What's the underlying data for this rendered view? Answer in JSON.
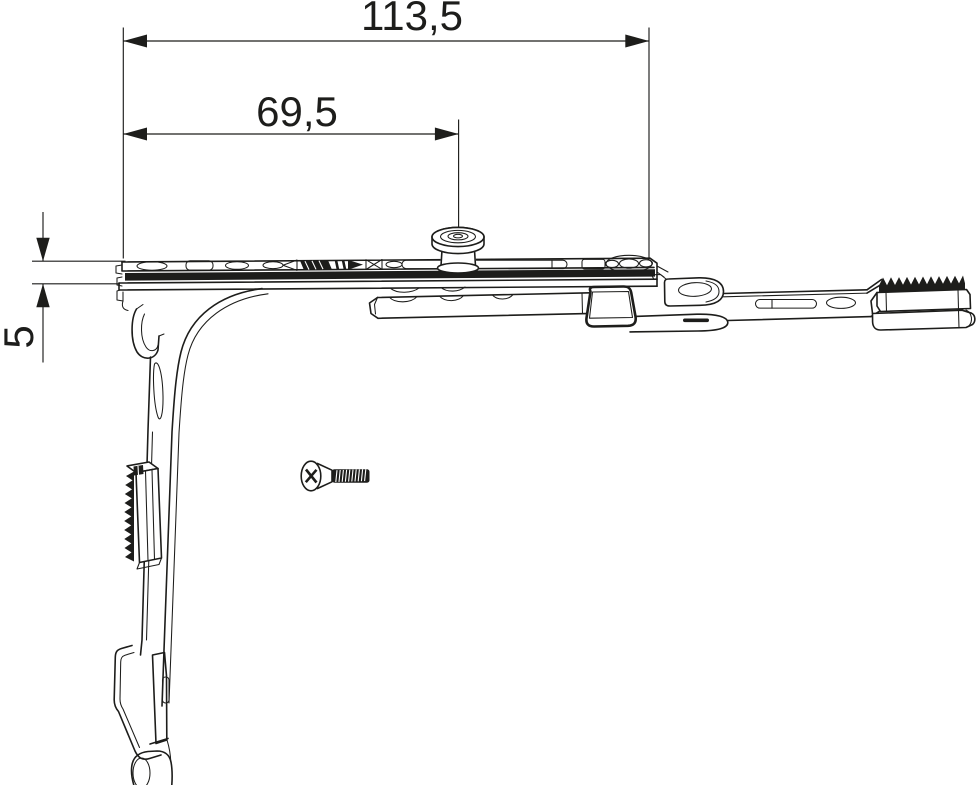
{
  "drawing": {
    "dimensions": {
      "overall_length": "113,5",
      "pin_position": "69,5",
      "edge_offset": "5"
    },
    "colors": {
      "line": "#1d1d1b",
      "background": "#ffffff"
    }
  }
}
